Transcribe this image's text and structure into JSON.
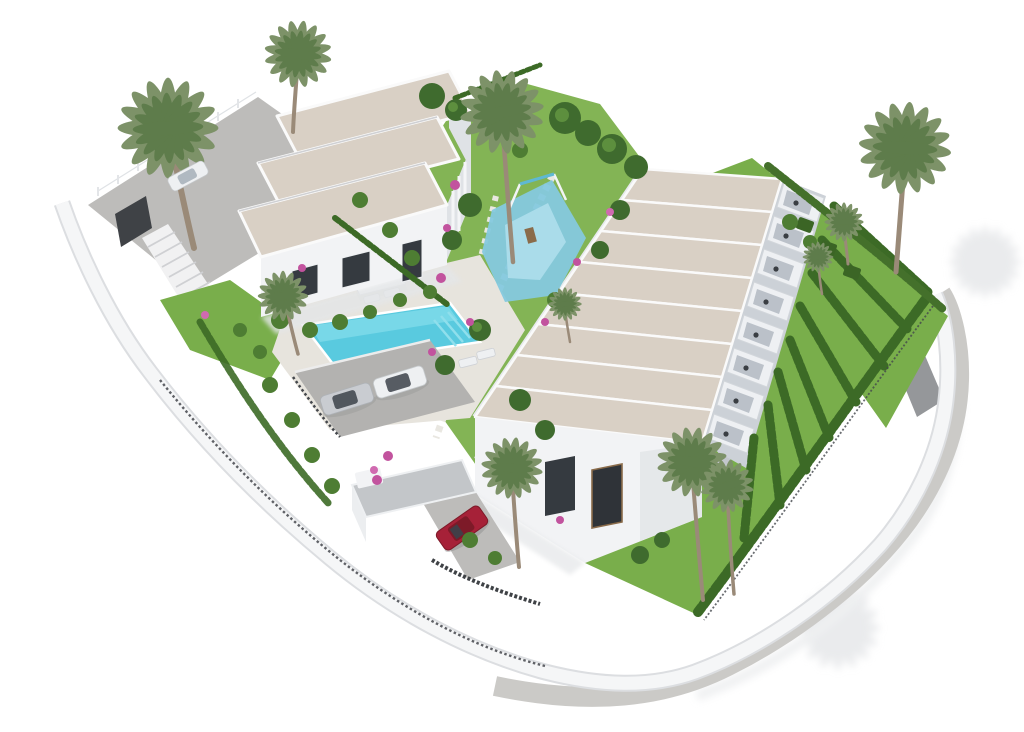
{
  "scene": {
    "title": "Aerial 3D architectural render of a white Mediterranean residential development",
    "style": "photorealistic CGI bird's-eye view on plain white background",
    "inventory": {
      "villa_block_roof_sections": 3,
      "townhouse_units": 8,
      "private_terraces": 8,
      "palm_trees": 11,
      "sun_loungers": 4,
      "pools": {
        "main_pool": 1,
        "kids_splash_pool": 1
      },
      "cars": {
        "silver": 1,
        "white": 1,
        "red_suv": 1,
        "white_on_driveway": 1
      },
      "amenities": [
        "swimming-pool",
        "kids-playground",
        "pergola",
        "carport",
        "parking-area",
        "entrance-gate",
        "staircase",
        "perimeter-road",
        "hedged-gardens"
      ]
    }
  },
  "palette": {
    "background": "#ffffff",
    "roof_sand": "#d9d0c5",
    "wall_white": "#f2f3f5",
    "wall_shade": "#dfe2e6",
    "wall_dark": "#ccd1d7",
    "glass": "#a9b2bb",
    "grass": "#79ae4b",
    "grass_light": "#86b957",
    "bush": "#4e7d33",
    "hedge": "#3c6a26",
    "cypress": "#44702b",
    "tree_dark": "#3f6b2e",
    "pool_water": "#59cadf",
    "pool_light": "#7edaea",
    "kids_pool": "#85c9de",
    "deck": "#e7e4dd",
    "driveway": "#bdbcba",
    "parking": "#b3b2b0",
    "path_gray": "#d2d3d0",
    "road": "#cbcac7",
    "ramp": "#95979a",
    "fence_dark": "#44474c",
    "gate_dark": "#3f4246",
    "car_red": "#a62138",
    "car_silver": "#c9ccd1",
    "car_white": "#eef0f2",
    "car_glass": "#3c424a",
    "palm_frond": "#7d9268",
    "palm_frond_dark": "#5e7c4b",
    "palm_trunk": "#9a8a78",
    "flower_pink": "#c2539e",
    "window_dark": "#353a40",
    "wood": "#8a6b4a",
    "shadow": "#dcdee1",
    "shadow_soft": "#e4e6e8"
  }
}
